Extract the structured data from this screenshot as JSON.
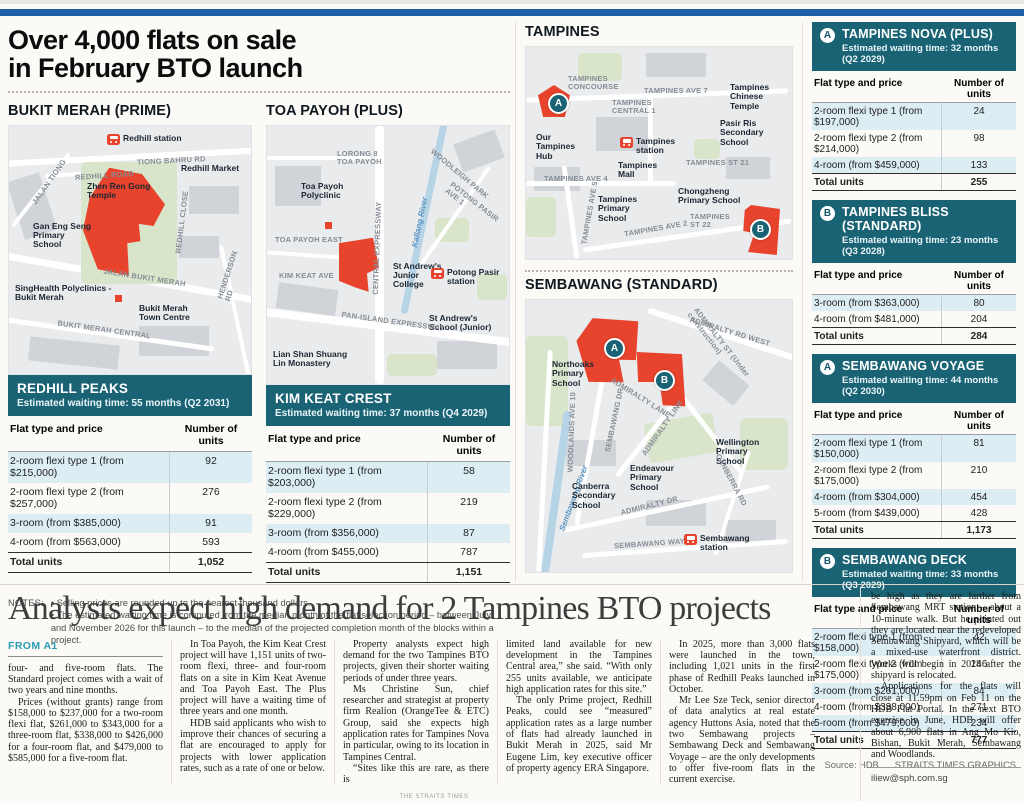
{
  "infographic": {
    "title": "Over 4,000 flats on sale\nin February BTO launch",
    "sections": {
      "bukit_merah": "BUKIT MERAH (PRIME)",
      "toa_payoh": "TOA PAYOH (PLUS)",
      "tampines": "TAMPINES",
      "sembawang": "SEMBAWANG (STANDARD)"
    },
    "maps": {
      "bukit_merah": {
        "labels": [
          {
            "text": "Redhill station",
            "type": "station",
            "x": 98,
            "y": 8
          },
          {
            "text": "TIONG BAHRU RD",
            "type": "road-label",
            "x": 128,
            "y": 31,
            "rot": -3
          },
          {
            "text": "JALAN TIONG",
            "type": "road-label",
            "x": 14,
            "y": 52,
            "rot": -55
          },
          {
            "text": "REDHILL ROAD",
            "type": "road-label",
            "x": 66,
            "y": 46,
            "rot": -4
          },
          {
            "text": "Redhill Market",
            "type": "place",
            "x": 172,
            "y": 38
          },
          {
            "text": "Zhen Ren Gong\nTemple",
            "type": "place",
            "x": 78,
            "y": 56
          },
          {
            "text": "Gan Eng Seng\nPrimary\nSchool",
            "type": "place",
            "x": 24,
            "y": 96
          },
          {
            "text": "REDHILL CLOSE",
            "type": "road-label",
            "x": 142,
            "y": 92,
            "rot": -83
          },
          {
            "text": "JALAN BUKIT MERAH",
            "type": "road-label",
            "x": 94,
            "y": 148,
            "rot": 9
          },
          {
            "text": "SingHealth Polyclinics -\nBukit Merah",
            "type": "place",
            "x": 6,
            "y": 158
          },
          {
            "text": "Bukit Merah\nTown Centre",
            "type": "place",
            "x": 130,
            "y": 178
          },
          {
            "text": "BUKIT MERAH CENTRAL",
            "type": "road-label",
            "x": 48,
            "y": 200,
            "rot": 8
          },
          {
            "text": "HENDERSON RD",
            "type": "road-label",
            "x": 198,
            "y": 142,
            "rot": -72
          }
        ]
      },
      "toa_payoh": {
        "labels": [
          {
            "text": "LORONG 8\nTOA PAYOH",
            "type": "road-label",
            "x": 70,
            "y": 24
          },
          {
            "text": "Toa Payoh\nPolyclinic",
            "type": "place",
            "x": 34,
            "y": 56
          },
          {
            "text": "TOA PAYOH EAST",
            "type": "road-label",
            "x": 8,
            "y": 110
          },
          {
            "text": "KIM KEAT AVE",
            "type": "road-label",
            "x": 12,
            "y": 146
          },
          {
            "text": "CENTRAL EXPRESSWAY",
            "type": "road-label",
            "x": 64,
            "y": 118,
            "rot": -88
          },
          {
            "text": "WOODLEIGH PARK",
            "type": "road-label",
            "x": 156,
            "y": 44,
            "rot": 40
          },
          {
            "text": "POTONG PASIR AVE 1",
            "type": "road-label",
            "x": 174,
            "y": 74,
            "rot": 38
          },
          {
            "text": "Kallang River",
            "type": "water",
            "x": 128,
            "y": 92,
            "rot": -78
          },
          {
            "text": "St Andrew's\nJunior\nCollege",
            "type": "place",
            "x": 126,
            "y": 136
          },
          {
            "text": "Potong Pasir\nstation",
            "type": "station",
            "x": 164,
            "y": 142
          },
          {
            "text": "St Andrew's\nSchool (Junior)",
            "type": "place",
            "x": 162,
            "y": 188
          },
          {
            "text": "PAN-ISLAND EXPRESSWAY",
            "type": "road-label",
            "x": 74,
            "y": 192,
            "rot": 8
          },
          {
            "text": "Lian Shan Shuang\nLin Monastery",
            "type": "place",
            "x": 6,
            "y": 224
          }
        ]
      },
      "tampines": {
        "labels": [
          {
            "text": "TAMPINES\nCONCOURSE",
            "type": "road-label",
            "x": 42,
            "y": 28
          },
          {
            "text": "A",
            "type": "marker",
            "x": 22,
            "y": 46
          },
          {
            "text": "TAMPINES AVE 7",
            "type": "road-label",
            "x": 118,
            "y": 40
          },
          {
            "text": "Tampines\nChinese\nTemple",
            "type": "place",
            "x": 204,
            "y": 36
          },
          {
            "text": "TAMPINES\nCENTRAL 1",
            "type": "road-label",
            "x": 86,
            "y": 52
          },
          {
            "text": "Pasir Ris\nSecondary\nSchool",
            "type": "place",
            "x": 194,
            "y": 72
          },
          {
            "text": "Our\nTampines\nHub",
            "type": "place",
            "x": 10,
            "y": 86
          },
          {
            "text": "Tampines\nstation",
            "type": "station",
            "x": 94,
            "y": 90
          },
          {
            "text": "Tampines\nMall",
            "type": "place",
            "x": 92,
            "y": 114
          },
          {
            "text": "TAMPINES ST 21",
            "type": "road-label",
            "x": 160,
            "y": 112
          },
          {
            "text": "TAMPINES AVE 4",
            "type": "road-label",
            "x": 18,
            "y": 128
          },
          {
            "text": "Chongzheng\nPrimary School",
            "type": "place",
            "x": 152,
            "y": 140
          },
          {
            "text": "Tampines\nPrimary\nSchool",
            "type": "place",
            "x": 72,
            "y": 148
          },
          {
            "text": "TAMPINES AVE 2",
            "type": "road-label",
            "x": 98,
            "y": 178,
            "rot": -10
          },
          {
            "text": "TAMPINES\nST 22",
            "type": "road-label",
            "x": 164,
            "y": 166
          },
          {
            "text": "B",
            "type": "marker",
            "x": 224,
            "y": 172
          },
          {
            "text": "TAMPINES AVE 5",
            "type": "road-label",
            "x": 32,
            "y": 162,
            "rot": -80
          }
        ]
      },
      "sembawang": {
        "labels": [
          {
            "text": "ADMIRALTY RD WEST",
            "type": "road-label",
            "x": 162,
            "y": 28,
            "rot": 17
          },
          {
            "text": "ADMIRALTY ST (Under construction)",
            "type": "road-label",
            "x": 142,
            "y": 52,
            "rot": 52
          },
          {
            "text": "A",
            "type": "marker",
            "x": 78,
            "y": 38
          },
          {
            "text": "B",
            "type": "marker",
            "x": 128,
            "y": 70
          },
          {
            "text": "Northoaks\nPrimary\nSchool",
            "type": "place",
            "x": 26,
            "y": 60
          },
          {
            "text": "ADMIRALTY LANE",
            "type": "road-label",
            "x": 80,
            "y": 94,
            "rot": 32
          },
          {
            "text": "SEMBAWANG DR",
            "type": "road-label",
            "x": 56,
            "y": 116,
            "rot": -78
          },
          {
            "text": "ADMIRALTY LINK",
            "type": "road-label",
            "x": 104,
            "y": 124,
            "rot": -55
          },
          {
            "text": "WOODLANDS AVE 10",
            "type": "road-label",
            "x": 6,
            "y": 128,
            "rot": -88
          },
          {
            "text": "Sembawang River",
            "type": "water",
            "x": 14,
            "y": 194,
            "rot": -70
          },
          {
            "text": "Canberra\nSecondary\nSchool",
            "type": "place",
            "x": 46,
            "y": 182
          },
          {
            "text": "Endeavour\nPrimary\nSchool",
            "type": "place",
            "x": 104,
            "y": 164
          },
          {
            "text": "Wellington\nPrimary\nSchool",
            "type": "place",
            "x": 190,
            "y": 138
          },
          {
            "text": "ADMIRALTY DR",
            "type": "road-label",
            "x": 94,
            "y": 202,
            "rot": -14
          },
          {
            "text": "CANBERRA RD",
            "type": "road-label",
            "x": 176,
            "y": 176,
            "rot": 62
          },
          {
            "text": "SEMBAWANG WAY",
            "type": "road-label",
            "x": 88,
            "y": 240,
            "rot": -4
          },
          {
            "text": "Sembawang\nstation",
            "type": "station",
            "x": 158,
            "y": 234
          }
        ]
      }
    },
    "tables": {
      "redhill_peaks": {
        "badge": "",
        "name": "REDHILL PEAKS",
        "waiting": "Estimated waiting time: 55 months (Q2 2031)",
        "col_headers": [
          "Flat type and price",
          "Number of units"
        ],
        "rows": [
          [
            "2-room flexi type 1 (from $215,000)",
            "92"
          ],
          [
            "2-room flexi type 2 (from $257,000)",
            "276"
          ],
          [
            "3-room (from $385,000)",
            "91"
          ],
          [
            "4-room (from $563,000)",
            "593"
          ]
        ],
        "total": [
          "Total units",
          "1,052"
        ]
      },
      "kim_keat_crest": {
        "badge": "",
        "name": "KIM KEAT CREST",
        "waiting": "Estimated waiting time: 37 months (Q4 2029)",
        "col_headers": [
          "Flat type and price",
          "Number of units"
        ],
        "rows": [
          [
            "2-room flexi type 1 (from $203,000)",
            "58"
          ],
          [
            "2-room flexi type 2 (from $229,000)",
            "219"
          ],
          [
            "3-room (from $356,000)",
            "87"
          ],
          [
            "4-room (from $455,000)",
            "787"
          ]
        ],
        "total": [
          "Total units",
          "1,151"
        ]
      },
      "tampines_nova": {
        "badge": "A",
        "name": "TAMPINES NOVA (PLUS)",
        "waiting": "Estimated waiting time: 32 months (Q2 2029)",
        "col_headers": [
          "Flat type and price",
          "Number of units"
        ],
        "rows": [
          [
            "2-room flexi type 1 (from $197,000)",
            "24"
          ],
          [
            "2-room flexi type 2 (from $214,000)",
            "98"
          ],
          [
            "4-room (from $459,000)",
            "133"
          ]
        ],
        "total": [
          "Total units",
          "255"
        ]
      },
      "tampines_bliss": {
        "badge": "B",
        "name": "TAMPINES BLISS (STANDARD)",
        "waiting": "Estimated waiting time: 23 months (Q3 2028)",
        "col_headers": [
          "Flat type and price",
          "Number of units"
        ],
        "rows": [
          [
            "3-room (from $363,000)",
            "80"
          ],
          [
            "4-room (from $481,000)",
            "204"
          ]
        ],
        "total": [
          "Total units",
          "284"
        ]
      },
      "sembawang_voyage": {
        "badge": "A",
        "name": "SEMBAWANG VOYAGE",
        "waiting": "Estimated waiting time: 44 months (Q2 2030)",
        "col_headers": [
          "Flat type and price",
          "Number of units"
        ],
        "rows": [
          [
            "2-room flexi type 1 (from $150,000)",
            "81"
          ],
          [
            "2-room flexi type 2 (from $175,000)",
            "210"
          ],
          [
            "4-room (from $304,000)",
            "454"
          ],
          [
            "5-room (from $439,000)",
            "428"
          ]
        ],
        "total": [
          "Total units",
          "1,173"
        ]
      },
      "sembawang_deck": {
        "badge": "B",
        "name": "SEMBAWANG DECK",
        "waiting": "Estimated waiting time: 33 months (Q3 2029)",
        "col_headers": [
          "Flat type and price",
          "Number of units"
        ],
        "rows": [
          [
            "2-room flexi type 1 (from $158,000)",
            "42"
          ],
          [
            "2-room flexi type 2 (from $175,000)",
            "146"
          ],
          [
            "3-room (from $261,000)",
            "84"
          ],
          [
            "4-room (from $338,000)",
            "271"
          ],
          [
            "5-room (from $479,000)",
            "234"
          ]
        ],
        "total": [
          "Total units",
          "777"
        ]
      }
    },
    "notes": {
      "label": "NOTES:",
      "items": [
        "Selling prices are rounded up to the nearest thousand dollars.",
        "The estimated waiting time is computed from the median month of the flat selection period – between July and November 2026 for this launch – to the median of the projected completion month of the blocks within a project."
      ]
    },
    "source": {
      "left": "Source: HDB",
      "right": "STRAITS TIMES GRAPHICS"
    },
    "colors": {
      "accent_teal": "#1a6375",
      "site_red": "#e8432c",
      "topbar_blue": "#1f5fa7",
      "row_stripe": "#dceef4"
    }
  },
  "article": {
    "headline": "Analysts expect high demand for 2 Tampines BTO projects",
    "kicker": "FROM A1",
    "columns": [
      {
        "paragraphs": [
          {
            "text": "four- and five-room flats. The Standard project comes with a wait of two years and nine months.",
            "indent": false
          },
          {
            "text": "Prices (without grants) range from $158,000 to $237,000 for a two-room flexi flat, $261,000 to $343,000 for a three-room flat, $338,000 to $426,000 for a four-room flat, and $479,000 to $585,000 for a five-room flat.",
            "indent": true
          }
        ]
      },
      {
        "paragraphs": [
          {
            "text": "In Toa Payoh, the Kim Keat Crest project will have 1,151 units of two-room flexi, three- and four-room flats on a site in Kim Keat Avenue and Toa Payoh East. The Plus project will have a waiting time of three years and one month.",
            "indent": true
          },
          {
            "text": "HDB said applicants who wish to improve their chances of securing a flat are encouraged to apply for projects with lower application rates, such as a rate of one or below.",
            "indent": true
          }
        ]
      },
      {
        "paragraphs": [
          {
            "text": "Property analysts expect high demand for the two Tampines BTO projects, given their shorter waiting periods of under three years.",
            "indent": true
          },
          {
            "text": "Ms Christine Sun, chief researcher and strategist at property firm Realion (OrangeTee & ETC) Group, said she expects high application rates for Tampines Nova in particular, owing to its location in Tampines Central.",
            "indent": true
          },
          {
            "text": "“Sites like this are rare, as there is",
            "indent": true
          }
        ]
      },
      {
        "paragraphs": [
          {
            "text": "limited land available for new development in the Tampines Central area,” she said. “With only 255 units available, we anticipate high application rates for this site.”",
            "indent": false
          },
          {
            "text": "The only Prime project, Redhill Peaks, could see “measured” application rates as a large number of flats had already launched in Bukit Merah in 2025, said Mr Eugene Lim, key executive officer of property agency ERA Singapore.",
            "indent": true
          }
        ]
      },
      {
        "paragraphs": [
          {
            "text": "In 2025, more than 3,000 flats were launched in the town, including 1,021 units in the first phase of Redhill Peaks launched in October.",
            "indent": true
          },
          {
            "text": "Mr Lee Sze Teck, senior director of data analytics at real estate agency Huttons Asia, noted that the two Sembawang projects – Sembawang Deck and Sembawang Voyage – are the only developments to offer five-room flats in the current exercise.",
            "indent": true
          },
          {
            "text": "He said application rates may not",
            "indent": true
          }
        ]
      },
      {
        "paragraphs": [
          {
            "text": "be high as they are farther from Sembawang MRT station – about a 10-minute walk. But he pointed out they are located near the redeveloped Sembawang Shipyard, which will be a mixed-use waterfront district. Works will begin in 2028 after the shipyard is relocated.",
            "indent": false
          },
          {
            "text": "Applications for the flats will close at 11.59pm on Feb 11 on the HDB Flat Portal. In the next BTO exercise in June, HDB will offer about 6,900 flats in Ang Mo Kio, Bishan, Bukit Merah, Sembawang and Woodlands.",
            "indent": true
          }
        ]
      }
    ],
    "email": "iliew@sph.com.sg",
    "footer": "THE STRAITS TIMES"
  }
}
